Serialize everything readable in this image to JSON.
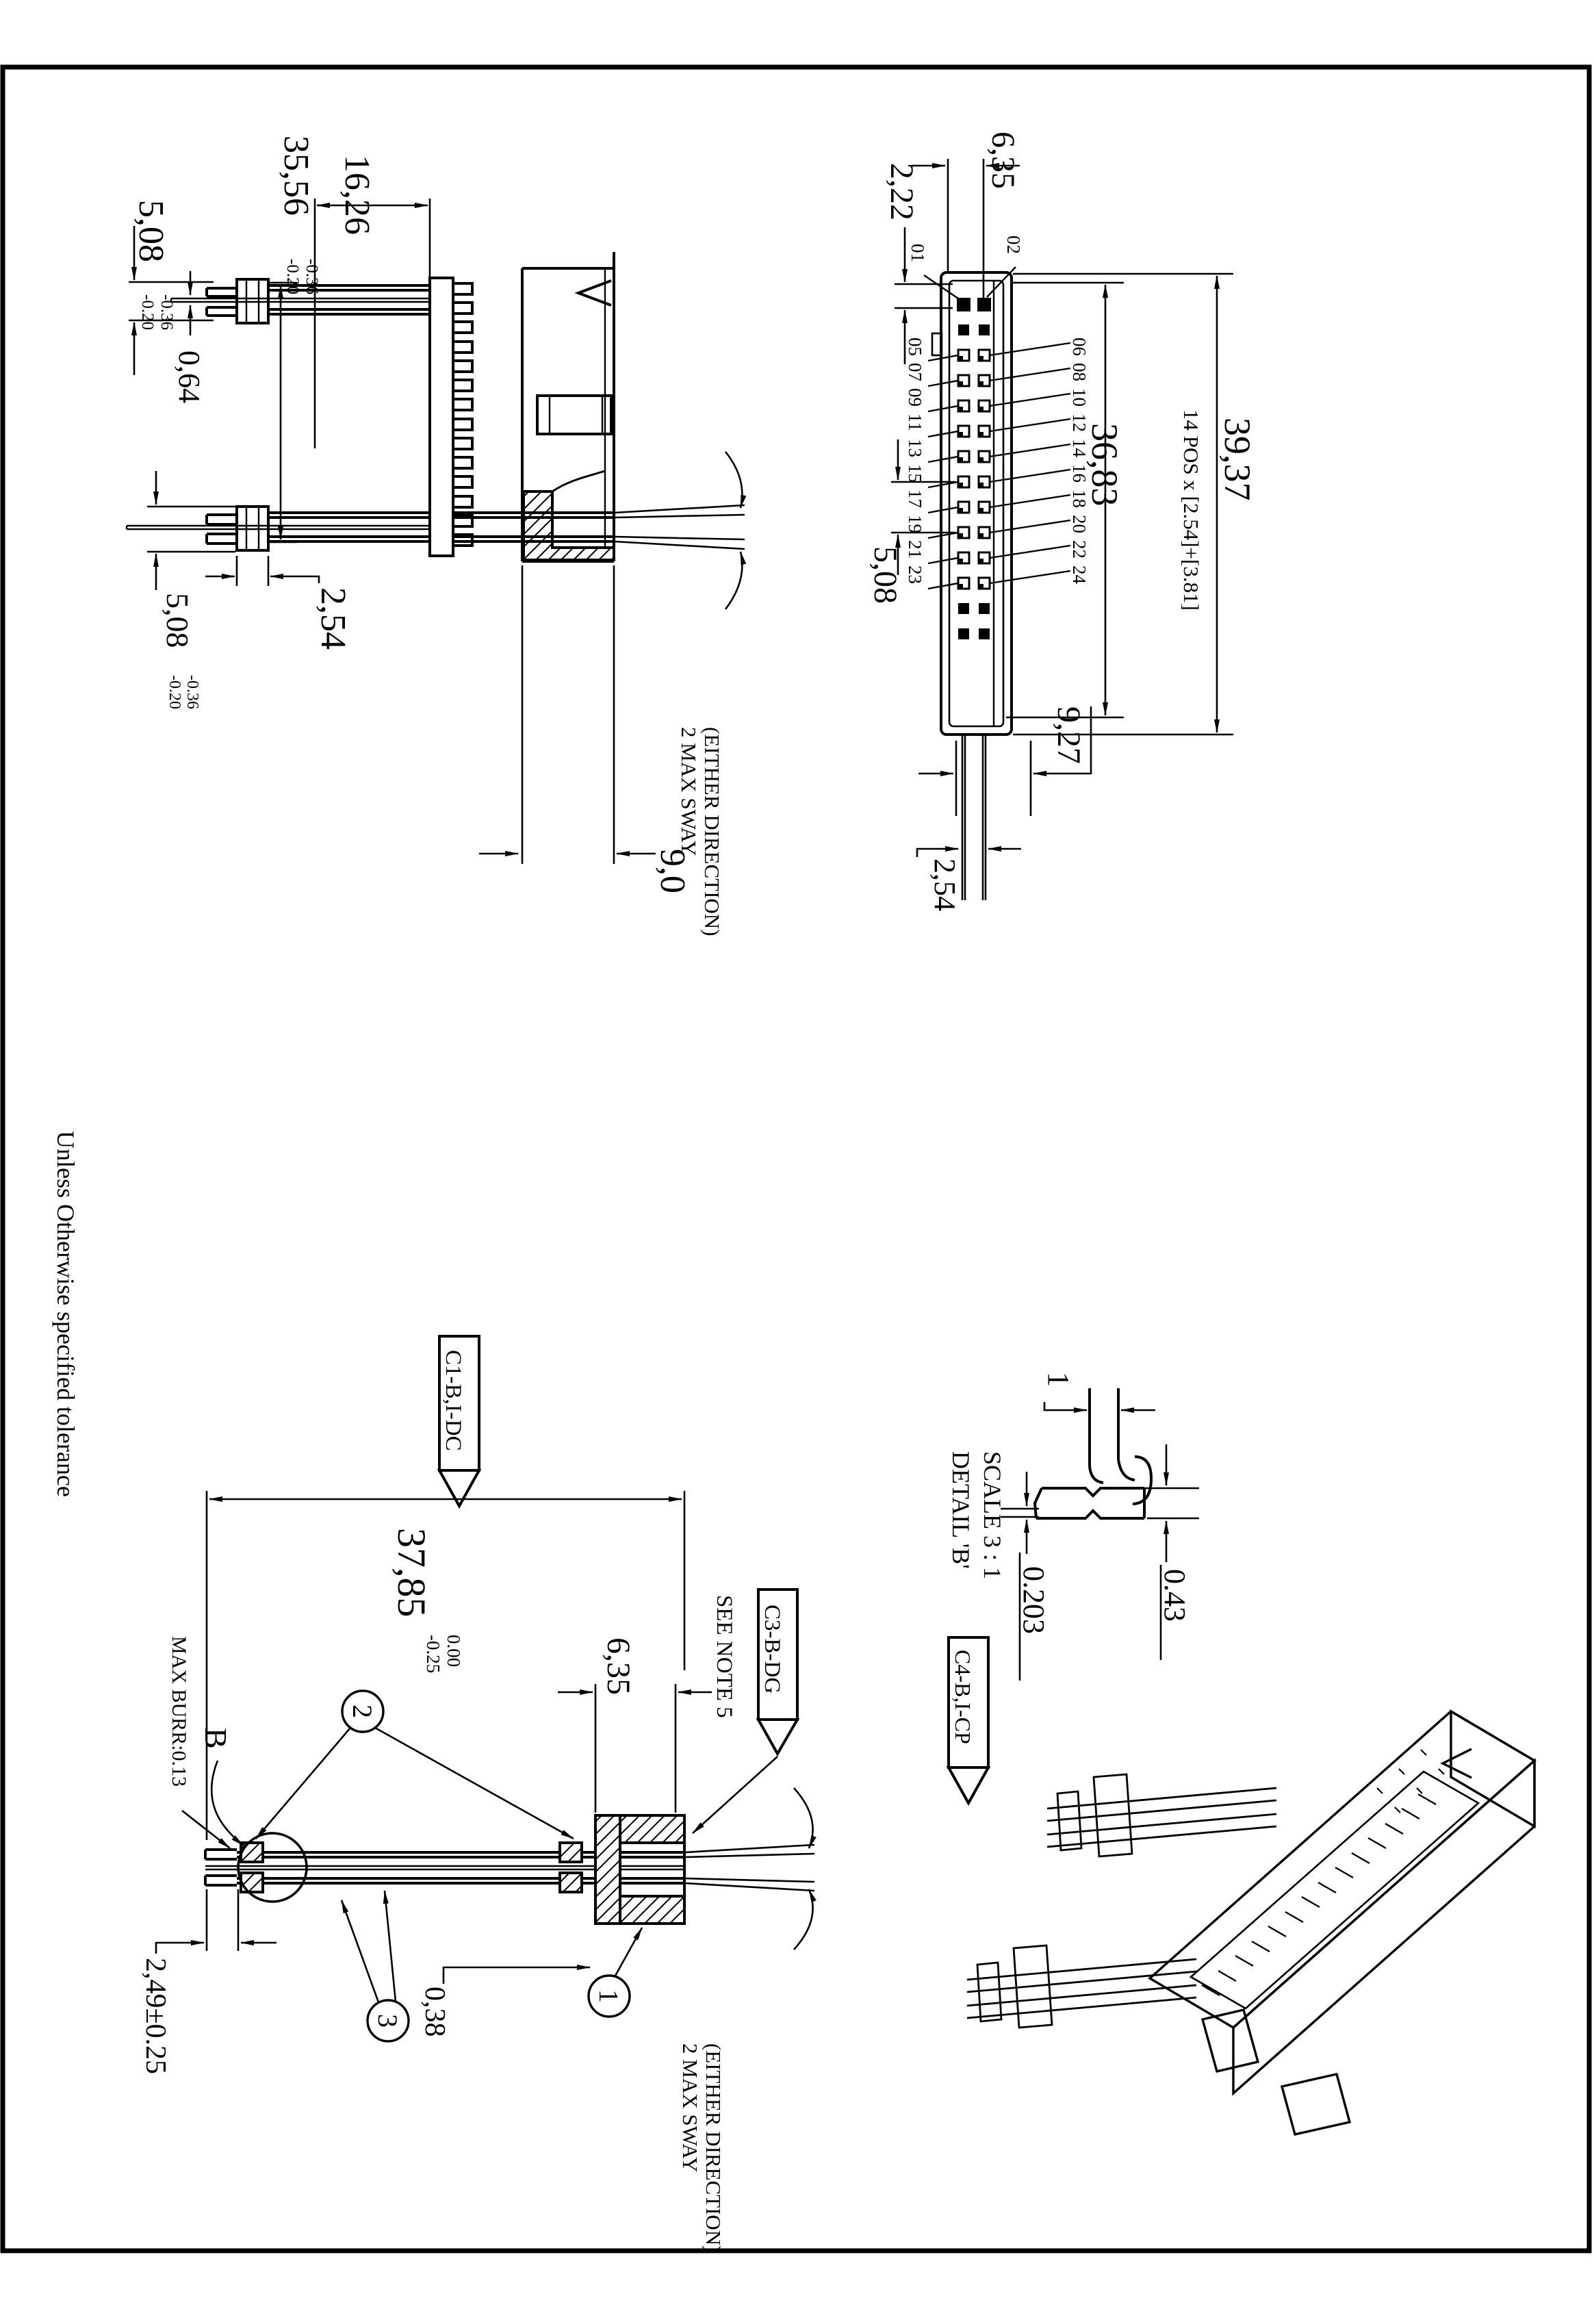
{
  "drawing": {
    "margin_note": "Unless Otherwise specified tolerance",
    "colors": {
      "ink": "#000000",
      "paper": "#ffffff"
    },
    "side_view": {
      "dim_pin_height": "5,08",
      "dim_pin_height_tol_up": "-0.36",
      "dim_pin_height_tol_dn": "-0.20",
      "dim_body_span": "35,56",
      "dim_body_span_tol_up": "-0.36",
      "dim_body_span_tol_dn": "-0.20",
      "dim_shroud_len": "16,26",
      "dim_pin_thk": "0,64",
      "dim_tip_pitch": "2,54",
      "dim_tail": "5,08",
      "dim_tail_tol_up": "-0.36",
      "dim_tail_tol_dn": "-0.20",
      "dim_depth": "9,0",
      "sway_line1": "2 MAX SWAY",
      "sway_line2": "(EITHER DIRECTION)"
    },
    "footprint_view": {
      "dim_top": "6,35",
      "dim_row_offset": "2,22",
      "dim_span_inner": "36,83",
      "dim_span_outer": "39,37",
      "pos_note": "14 POS x [2.54]+[3.81]",
      "dim_pitch2": "5,08",
      "dim_end": "9,27",
      "dim_pitch": "2,54",
      "labels_left": [
        "01",
        "05",
        "07",
        "09",
        "11",
        "13",
        "15",
        "17",
        "19",
        "21",
        "23"
      ],
      "labels_right": [
        "02",
        "06",
        "08",
        "10",
        "12",
        "14",
        "16",
        "18",
        "20",
        "22",
        "24"
      ]
    },
    "front_view": {
      "dim_overall": "37,85",
      "dim_overall_tol_up": "0.00",
      "dim_overall_tol_dn": "-0.25",
      "dim_tip": "2,49±0.25",
      "dim_wall": "0,38",
      "dim_shroud": "6,35",
      "note_burr": "MAX BURR:0.13",
      "note_see": "SEE NOTE 5",
      "detail_mark": "B",
      "flag_c1": "C1-B,I-DC",
      "flag_c3": "C3-B-DG",
      "balloon_1": "1",
      "balloon_2": "2",
      "balloon_3": "3",
      "sway_line1": "2 MAX SWAY",
      "sway_line2": "(EITHER DIRECTION)"
    },
    "detail_view": {
      "title": "DETAIL 'B'",
      "scale": "SCALE 3 : 1",
      "dim_width": "1",
      "dim_edge": "0.203",
      "dim_thk": "0.43",
      "flag_c4": "C4-B,I-CP"
    }
  }
}
